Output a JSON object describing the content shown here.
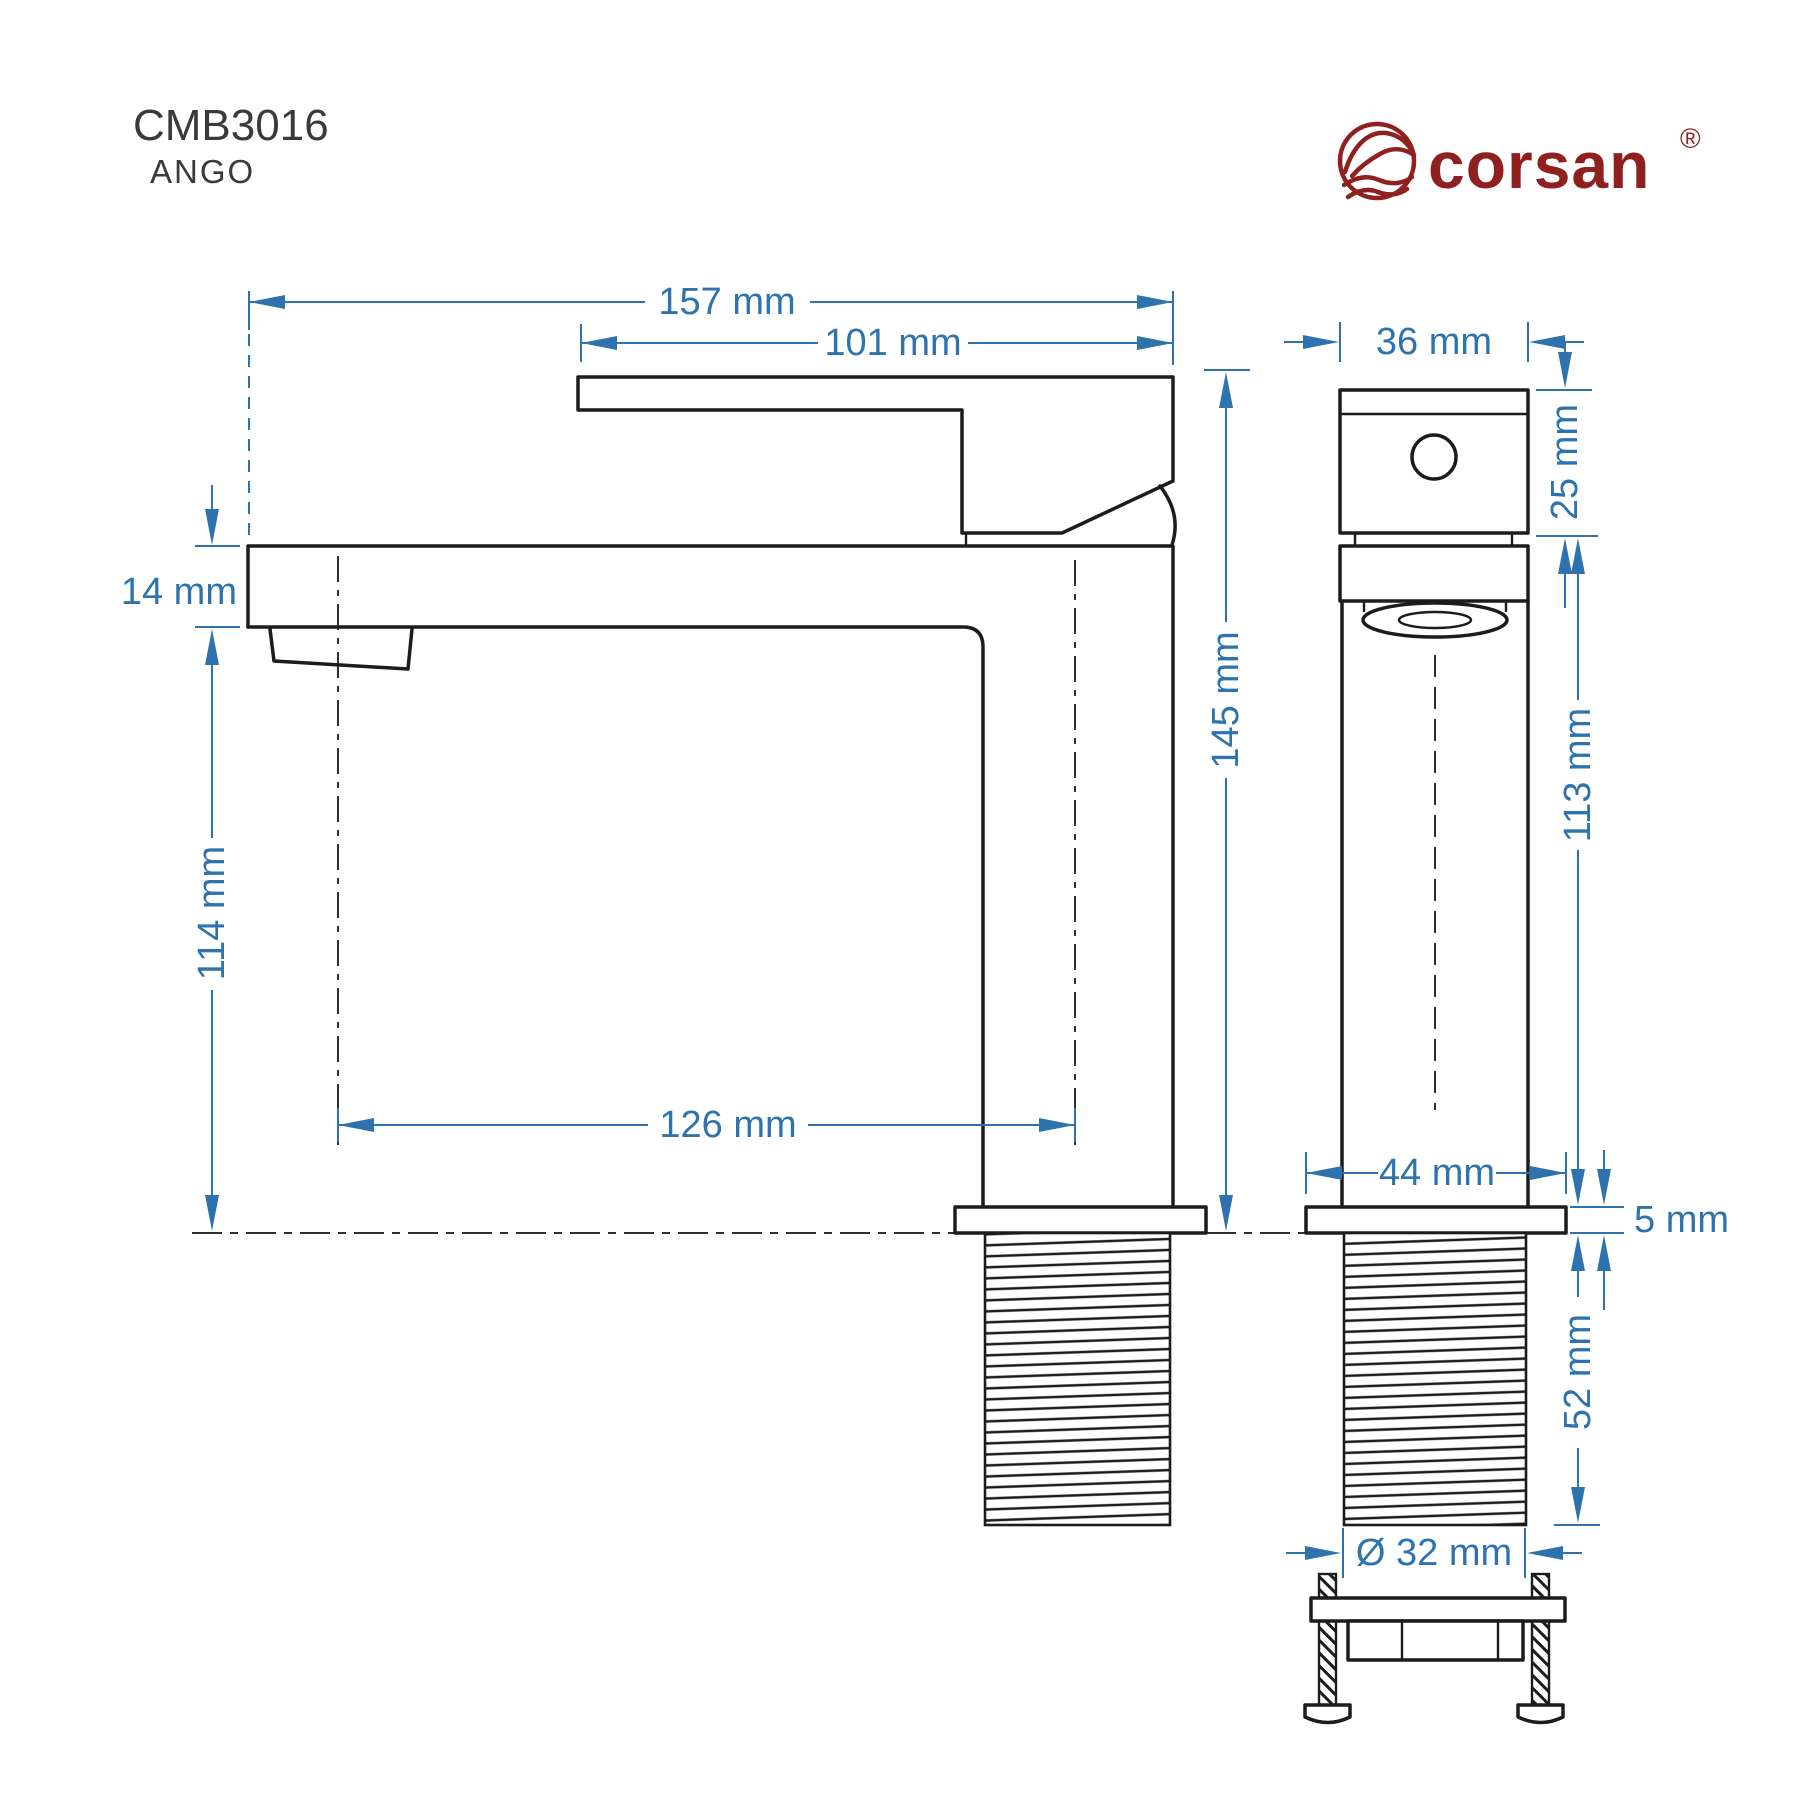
{
  "title": {
    "model": "CMB3016",
    "series": "ANGO"
  },
  "brand": {
    "name": "corsan",
    "registered_mark": "®"
  },
  "colors": {
    "dimension_blue": "#2e73ad",
    "drawing_black": "#1c1c1c",
    "brand_red": "#8e2020",
    "title_gray": "#3a3a3a",
    "background": "#ffffff"
  },
  "dimensions": {
    "overall_length": "157 mm",
    "handle_length": "101 mm",
    "spout_thickness": "14 mm",
    "spout_height": "114 mm",
    "spout_offset": "126 mm",
    "overall_height": "145 mm",
    "body_width": "36 mm",
    "handle_block_height": "25 mm",
    "body_height": "113 mm",
    "base_width": "44 mm",
    "base_plate_thickness": "5 mm",
    "thread_length": "52 mm",
    "thread_diameter": "Ø 32 mm"
  }
}
